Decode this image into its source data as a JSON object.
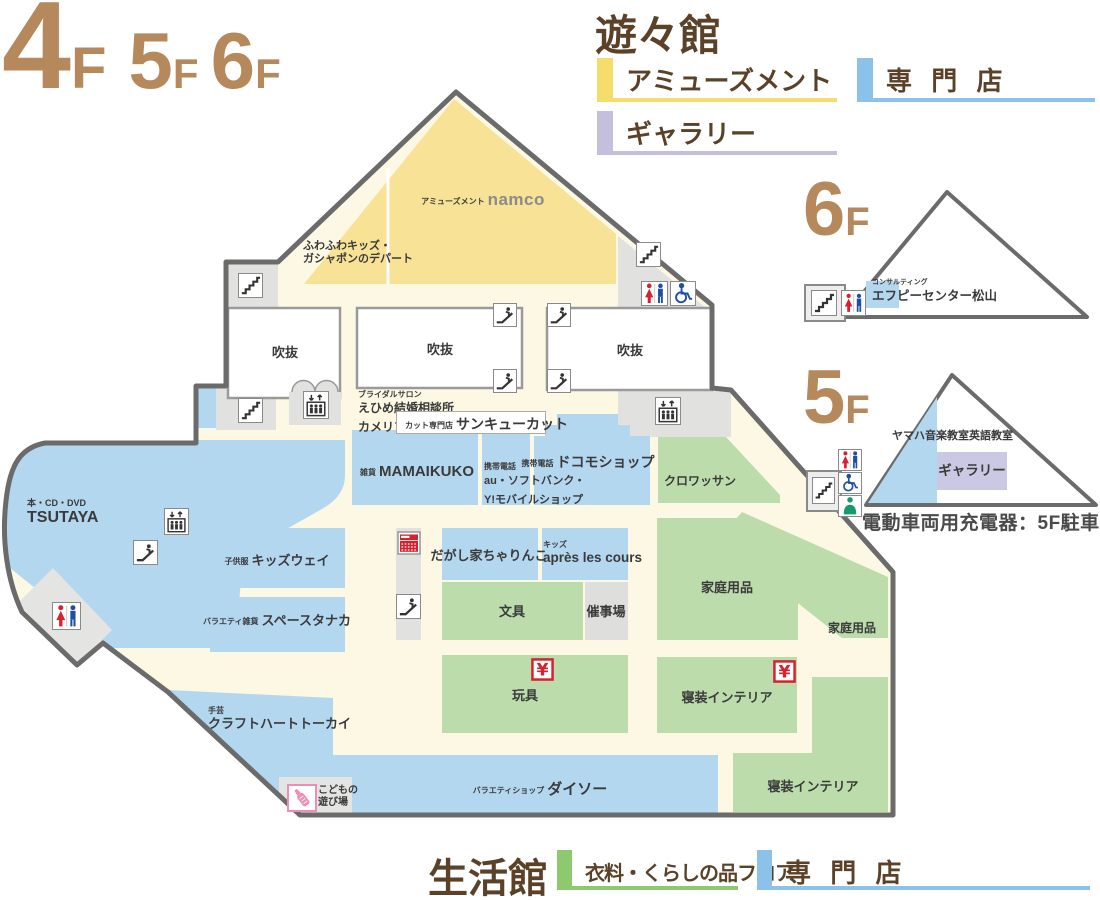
{
  "floor_indicator": [
    {
      "num": "4",
      "suffix": "F"
    },
    {
      "num": "5",
      "suffix": "F"
    },
    {
      "num": "6",
      "suffix": "F"
    }
  ],
  "legend_top": {
    "title": "遊々館",
    "items": [
      {
        "label": "アミューズメント",
        "color": "#F6DC6A"
      },
      {
        "label": "専 門 店",
        "color": "#8CC2E9"
      },
      {
        "label": "ギャラリー",
        "color": "#C3BFDC"
      }
    ]
  },
  "legend_bottom": {
    "title": "生活館",
    "items": [
      {
        "label": "衣料・くらしの品フロア",
        "color": "#8CC96F"
      },
      {
        "label": "専 門 店",
        "color": "#8CC2E9"
      }
    ]
  },
  "map": {
    "void_label": "吹抜",
    "stores": {
      "namco": {
        "category": "アミューズメント",
        "name": "namco"
      },
      "fuwafuwa": {
        "line1": "ふわふわキッズ・",
        "line2": "ガシャポンのデパート"
      },
      "bridal": {
        "category": "ブライダルサロン",
        "line1": "えひめ結婚相談所",
        "line2": "カメリア"
      },
      "cut": {
        "category": "カット専門店",
        "name": "サンキューカット"
      },
      "mamaikuko": {
        "category": "雑貨",
        "name": "MAMAIKUKO"
      },
      "mobile": {
        "category": "携帯電話",
        "line1": "au・ソフトバンク・",
        "line2": "Y!モバイルショップ"
      },
      "docomo": {
        "category": "携帯電話",
        "name": "ドコモショップ"
      },
      "croissant": {
        "name": "クロワッサン"
      },
      "tsutaya": {
        "category": "本・CD・DVD",
        "name": "TSUTAYA"
      },
      "kidsway": {
        "category": "子供服",
        "name": "キッズウェイ"
      },
      "spacetanaka": {
        "category": "バラエティ雑貨",
        "name": "スペースタナカ"
      },
      "dagashiya": {
        "name": "だがし家ちゃりんこ"
      },
      "apres": {
        "category": "キッズ",
        "name": "après les cours"
      },
      "stationery": {
        "name": "文具"
      },
      "event_space": {
        "name": "催事場"
      },
      "household_main": {
        "name": "家庭用品"
      },
      "household_edge": {
        "name": "家庭用品"
      },
      "toys": {
        "name": "玩具"
      },
      "bedding_main": {
        "name": "寝装インテリア"
      },
      "bedding_corner": {
        "name": "寝装インテリア"
      },
      "craftheart": {
        "category": "手芸",
        "name": "クラフトハートトーカイ"
      },
      "daiso": {
        "category": "バラエティショップ",
        "name": "ダイソー"
      },
      "kids_play": {
        "line1": "こどもの",
        "line2": "遊び場"
      }
    }
  },
  "inset_6f": {
    "floor": "6",
    "floor_suffix": "F",
    "tenant": {
      "category": "コンサルティング",
      "name": "エフピーセンター松山"
    }
  },
  "inset_5f": {
    "floor": "5",
    "floor_suffix": "F",
    "yamaha": "ヤマハ音楽教室英語教室",
    "gallery": "ギャラリー",
    "charger_note": "電動車両用充電器：5F駐車場"
  },
  "palette": {
    "amusement_yellow": "#F7E295",
    "specialty_blue": "#B4D7F0",
    "living_green": "#BCDDAB",
    "gallery_purple": "#CBC8E3",
    "corridor_cream": "#FCF8E3",
    "gray_zone": "#E1E1DF",
    "wall_gray": "#6B6B6B",
    "title_brown": "#5A4127",
    "floor_tan": "#B6895C",
    "toilet_red": "#D6212F",
    "toilet_blue": "#1D50A2",
    "nursing_green": "#18996B",
    "yen_red": "#D6212F",
    "kids_pink": "#F08CB5"
  }
}
